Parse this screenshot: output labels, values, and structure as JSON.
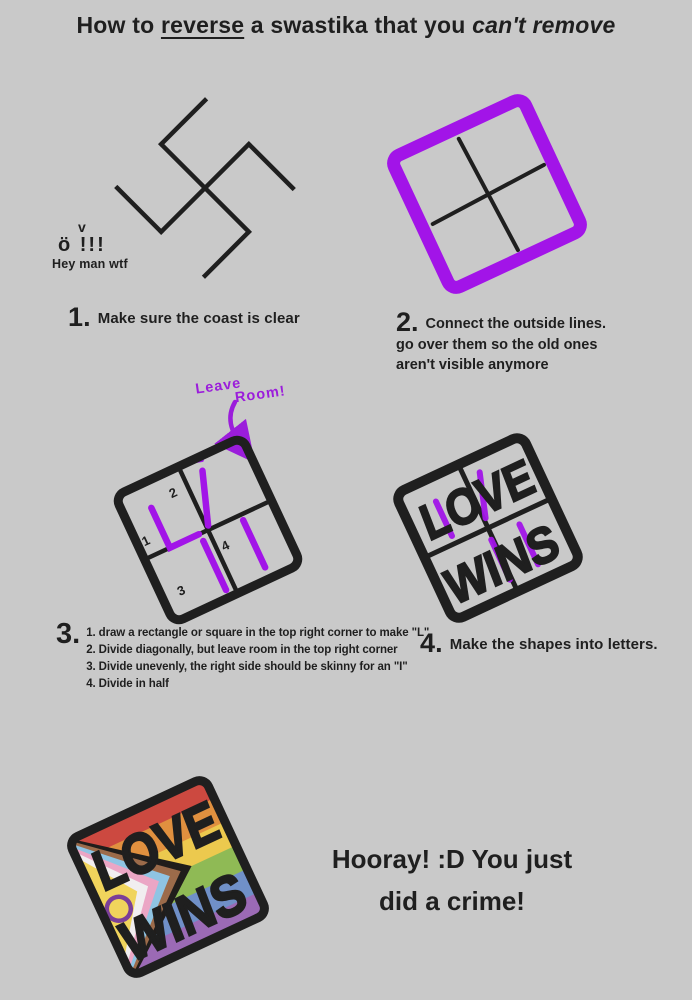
{
  "title": {
    "prefix": "How to ",
    "underlined": "reverse",
    "middle": " a swastika that you ",
    "emphasis": "can't remove"
  },
  "colors": {
    "bg": "#c9c9c9",
    "ink": "#1f1f1f",
    "purple": "#a214e8",
    "annotation_purple": "#9b1ddb",
    "rainbow": [
      "#cc4940",
      "#e0903f",
      "#ecc94e",
      "#8fba55",
      "#7090c8",
      "#9b6ab5"
    ],
    "chevron_black": "#201d1b",
    "chevron_brown": "#9c6b4a",
    "chevron_blue": "#8fc4e3",
    "chevron_pink": "#eba6c5",
    "chevron_white": "#f1eef0",
    "intersex_yellow": "#f0d45c",
    "intersex_purple": "#7b3f98"
  },
  "step1": {
    "number": "1.",
    "caption": "Make sure the coast is clear",
    "bystander_eyebrow": "v",
    "bystander_face": "ö !!!",
    "bystander_speech": "Hey man wtf"
  },
  "step2": {
    "number": "2.",
    "caption_lines": [
      "Connect the outside lines.",
      "go over them so the old ones",
      "aren't visible anymore"
    ]
  },
  "step3": {
    "number": "3.",
    "annotation_line1": "Leave",
    "annotation_line2": "Room!",
    "labels": [
      "1",
      "2",
      "3",
      "4"
    ],
    "substeps": [
      "1. draw a rectangle or square in the top right corner to make \"L\"",
      "2. Divide diagonally, but leave room in the top right corner",
      "3. Divide unevenly, the right side should be skinny for an \"I\"",
      "4. Divide in half"
    ]
  },
  "step4": {
    "number": "4.",
    "caption": "Make the shapes into letters.",
    "word_top": "LOVE",
    "word_bottom": "WINS"
  },
  "finale": {
    "word_top": "LOVE",
    "word_bottom": "WINS",
    "caption_lines": [
      "Hooray! :D You just",
      "did a crime!"
    ]
  }
}
